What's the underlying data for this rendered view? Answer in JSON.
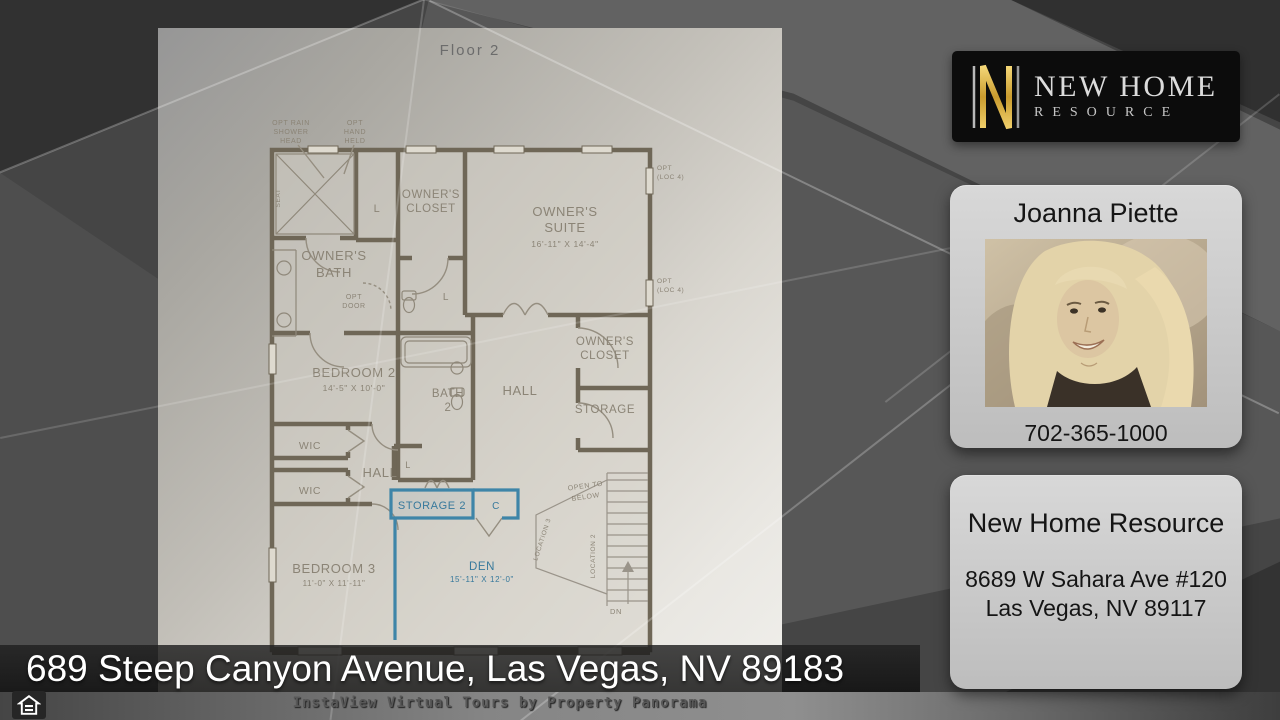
{
  "page": {
    "address_bar": "689 Steep Canyon Avenue, Las Vegas, NV 89183",
    "footer": "InstaView Virtual Tours by Property Panorama"
  },
  "logo": {
    "monogram": "N",
    "line1": "NEW HOME",
    "line2": "RESOURCE"
  },
  "agent": {
    "name": "Joanna Piette",
    "phone": "702-365-1000"
  },
  "office": {
    "name": "New Home Resource",
    "address1": "8689 W Sahara Ave #120",
    "address2": "Las Vegas, NV 89117"
  },
  "plan": {
    "title": "Floor 2",
    "highlight_color": "#37799c",
    "rooms": {
      "owners_suite": [
        "OWNER'S",
        "SUITE",
        "16'-11\" X 14'-4\""
      ],
      "owners_bath": [
        "OWNER'S",
        "BATH"
      ],
      "owners_closet1": [
        "OWNER'S",
        "CLOSET"
      ],
      "owners_closet2": [
        "OWNER'S",
        "CLOSET"
      ],
      "bedroom2": [
        "BEDROOM 2",
        "14'-5\" X 10'-0\""
      ],
      "bedroom3": [
        "BEDROOM 3",
        "11'-0\" X 11'-11\""
      ],
      "bath2": [
        "BATH",
        "2"
      ],
      "den": [
        "DEN",
        "15'-11\" X 12'-0\""
      ],
      "hall_upper": "HALL",
      "hall_lower": "HALL",
      "storage": "STORAGE",
      "storage2": "STORAGE 2",
      "wic1": "WIC",
      "wic2": "WIC",
      "closet_c": "C",
      "linen1": "L",
      "linen2": "L",
      "linen3": "L"
    },
    "annotations": {
      "opt_rain": [
        "OPT RAIN",
        "SHOWER",
        "HEAD"
      ],
      "opt_hand": [
        "OPT",
        "HAND",
        "HELD"
      ],
      "opt_door": [
        "OPT",
        "DOOR"
      ],
      "opt_loc4a": [
        "OPT",
        "(LOC 4)"
      ],
      "opt_loc4b": [
        "OPT",
        "(LOC 4)"
      ],
      "seat": "SEAT",
      "open_below": [
        "OPEN TO",
        "BELOW"
      ],
      "location2": "LOCATION 2",
      "location3": "LOCATION 3",
      "dn": "DN"
    }
  }
}
